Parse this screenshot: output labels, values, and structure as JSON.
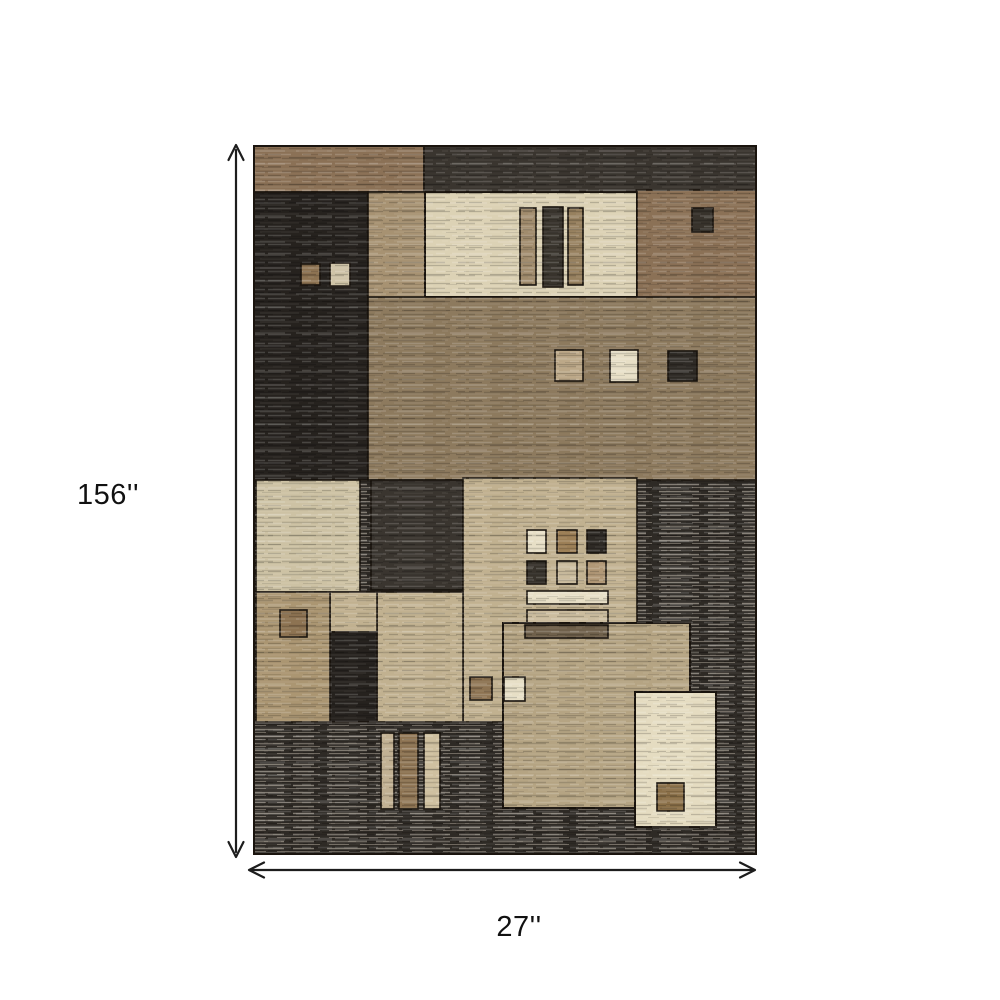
{
  "image": {
    "type": "rug dimension diagram",
    "labels": {
      "height": "156''",
      "width": "27''"
    }
  },
  "palette": {
    "background": "#ffffff",
    "text": "#111111",
    "dim-line": "#1d1d1d",
    "outline": "#1a140e",
    "dark": "#2e2a25",
    "dark-streak": "#3a352f",
    "dark-deep": "#26221e",
    "dark-square": "#38332c",
    "brown": "#8b7156",
    "brown-band": "#8d7a5e",
    "brown-square": "#8d7352",
    "brown-deep": "#8b7048",
    "tan-column": "#a79272",
    "tan-central": "#c1b190",
    "tan-big": "#b5a483",
    "tan-left": "#ab9672",
    "tan-square": "#bca888",
    "cream": "#dcd2b5",
    "cream-light": "#e5dcc1",
    "cream-pale": "#e7dfc6",
    "beige": "#cdc2a4",
    "beige-light": "#cfc4a8",
    "bar-tan": "#c2b193",
    "bar-cream": "#cfc0a0",
    "vbar-tan": "#a18c6d",
    "vbar-brown": "#97815f",
    "grid-brown": "#9d8057",
    "grid-tan": "#cbbc9e",
    "grid-tan-brown": "#b19876",
    "hbar-brown": "#6f604b"
  }
}
